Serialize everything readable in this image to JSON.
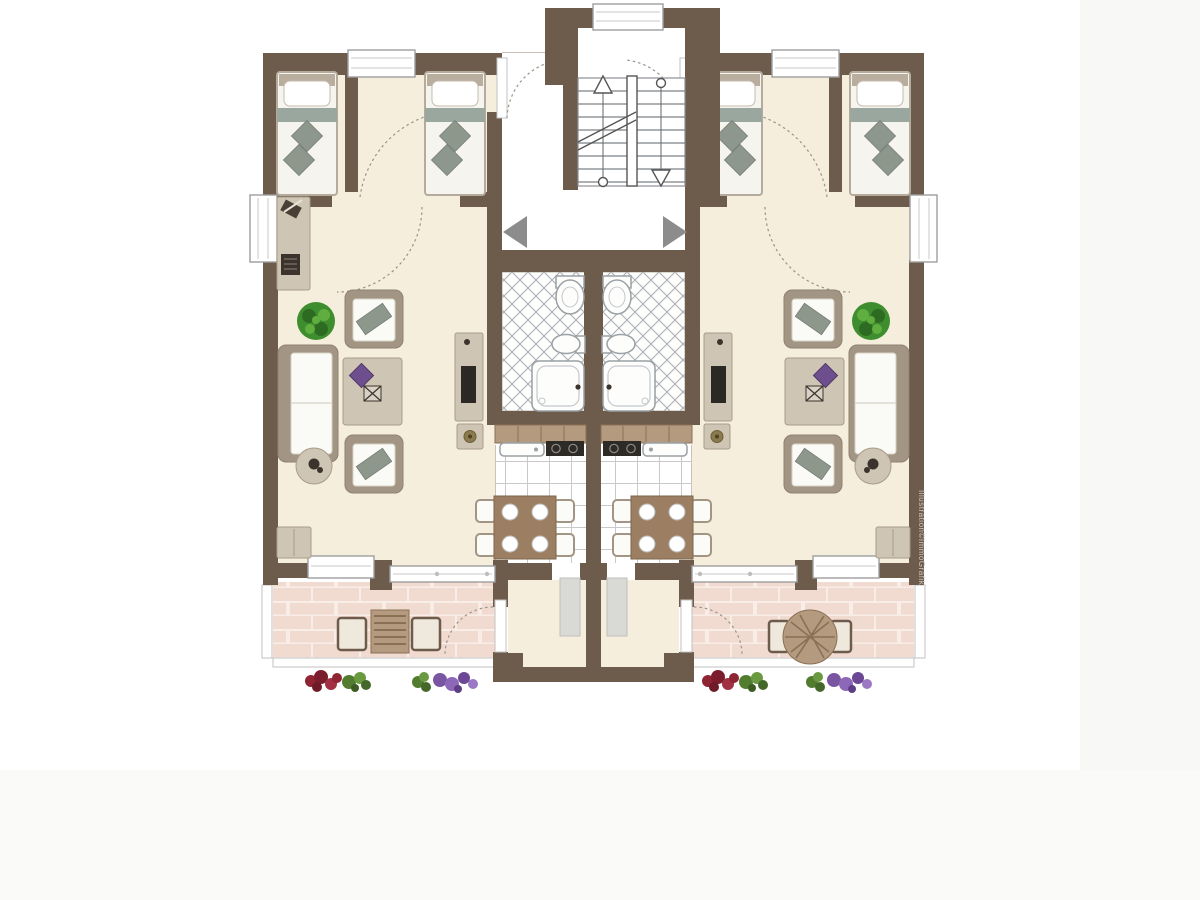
{
  "page": {
    "background": "#ffffff",
    "watermark": "Illustration©ImmoGrafik",
    "description_not_rendered": ""
  },
  "colors": {
    "wall": "#6d5b4c",
    "floor_cream": "#f6eedc",
    "tile_line": "#c9c9c9",
    "lattice_line": "#a8adb3",
    "brick": "#f1dbd1",
    "brick_line": "#f9ede7",
    "furniture_frame": "#a39583",
    "furniture_light": "#cfc5b4",
    "cushion_white": "#fafaf7",
    "cushion_gray": "#8e978c",
    "bed_band": "#9aa79f",
    "wood": "#9c7f63",
    "wood_light": "#b49a7e",
    "plant_green": "#3e8d2f",
    "flower_red": "#7d2030",
    "flower_purple": "#7a55a2",
    "flower_green": "#527c2e",
    "arrow_gray": "#8c8c8c",
    "dark_item": "#3c342c",
    "window_fill": "#ffffff",
    "window_frame": "#9e9e9e",
    "doormat": "#d9d9d6",
    "stove_dark": "#2e2a26",
    "stair_line": "#7e8287"
  },
  "icons": {
    "stair_up_arrow": "△",
    "stair_down_arrow": "▽",
    "entrance_arrow_left": "◀",
    "entrance_arrow_right": "▶"
  }
}
